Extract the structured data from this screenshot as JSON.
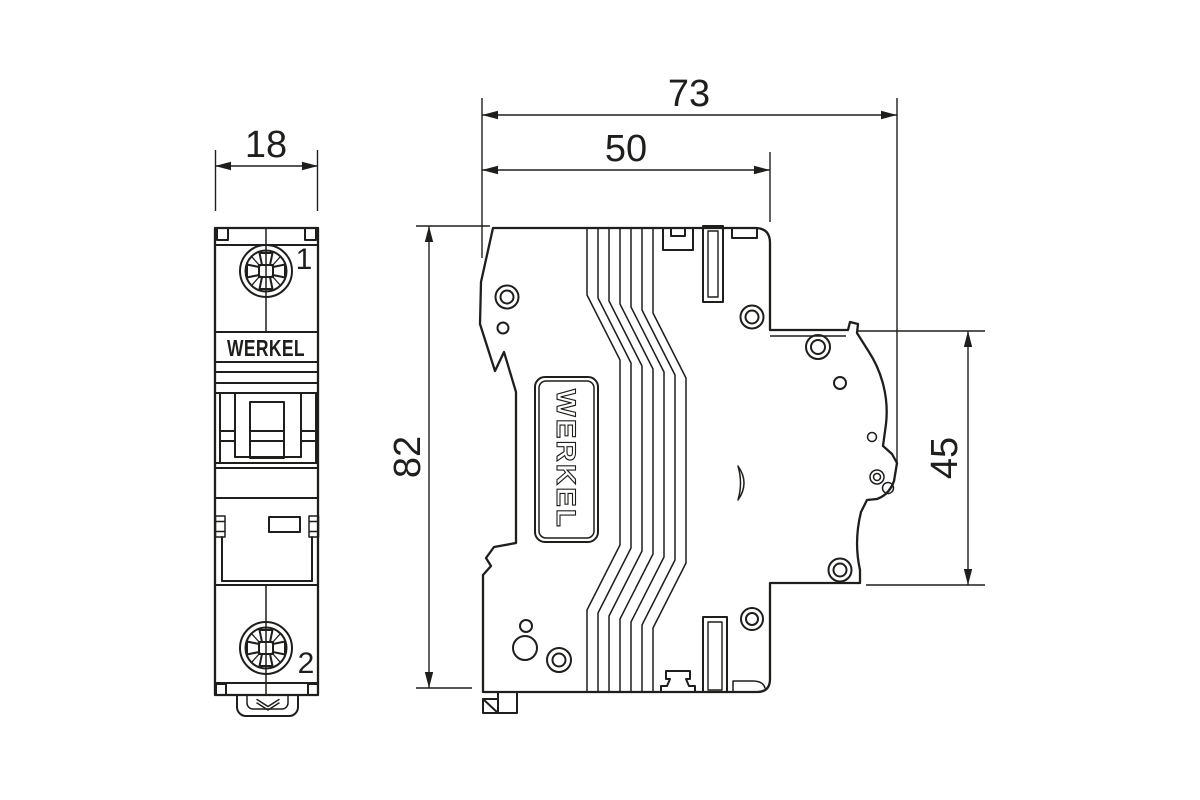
{
  "front_view": {
    "brand_label": "WERKEL",
    "width_dim": "18",
    "terminal_top_label": "1",
    "terminal_bottom_label": "2"
  },
  "side_view": {
    "brand_label": "WERKEL",
    "overall_width_dim": "73",
    "upper_body_width_dim": "50",
    "height_dim": "82",
    "right_section_height_dim": "45"
  },
  "colors": {
    "line": "#1e1e1c",
    "background": "#ffffff"
  }
}
